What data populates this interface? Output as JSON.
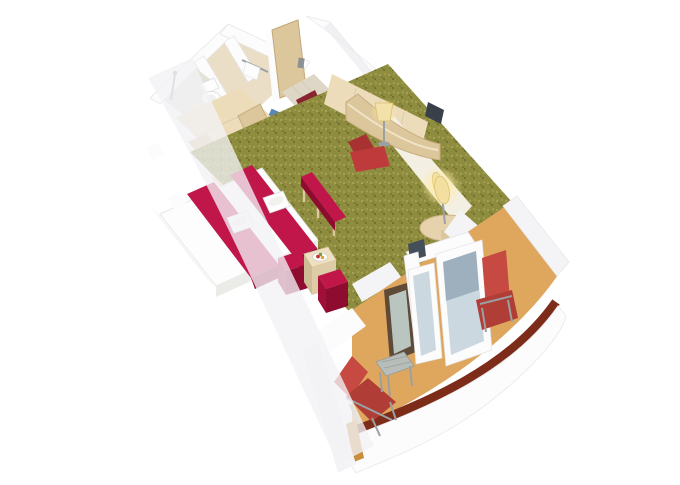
{
  "scene": {
    "title": "3D cutaway render of a cruise-ship balcony stateroom floor plan",
    "type": "isometric architectural rendering, no visible text",
    "areas": [
      {
        "name": "bathroom",
        "description": "top-left wet unit with shower stall, toilet and second shower compartment, beige walls with white wall tops"
      },
      {
        "name": "wardrobe",
        "description": "light wood closet and open shelving with stepped shelf unit next to bathroom"
      },
      {
        "name": "entry",
        "description": "wooden cabin door at top with red striped runner mat leading onto the carpet"
      },
      {
        "name": "living-area",
        "description": "olive-green speckled carpet, double bed with white duvet, two crimson bed runners with folded white towels, crimson bench at bed foot, two crimson stools and light wood coffee table with fruit tray"
      },
      {
        "name": "desk-area",
        "description": "curved light-wood desk with lit table lamp, red desk chair, wood cabinets and TV along right wall, cream wall with glowing sconce, round pedestal side table with floor lamp"
      },
      {
        "name": "balcony",
        "description": "tan-floored private balcony behind white sliding glass door unit, two red deck chairs, grey metal side table, white ship hull with dark red trim stripe curving along the edge"
      }
    ],
    "objects": [
      "shower",
      "toilet",
      "towel-rail",
      "wardrobe-shelves",
      "step-shelves",
      "cabin-door",
      "striped-entry-mat",
      "double-bed",
      "bed-runner",
      "towel-set",
      "bed-bench",
      "stool",
      "stool",
      "coffee-table",
      "fruit-tray",
      "desk",
      "desk-lamp",
      "desk-chair",
      "tv",
      "wall-sconce",
      "side-table",
      "floor-lamp",
      "sliding-door-unit",
      "open-glass-door",
      "deck-lounger",
      "deck-chair",
      "balcony-table",
      "ship-hull",
      "hull-trim-stripe",
      "ghost-hull-wall"
    ]
  },
  "colors": {
    "hull-white": "#fcfcfd",
    "wall-white": "#f4f4f6",
    "wall-cream": "#f3efe2",
    "wood-light": "#ecdcba",
    "wood-mid": "#dcc69c",
    "wood-dark": "#c6ab7e",
    "carpet": "#8e8c3e",
    "carpet-dot-light": "#aba75a",
    "carpet-dot-dark": "#6c6a28",
    "crimson": "#c0164a",
    "crimson-mid": "#a00f36",
    "crimson-dark": "#8e0c2f",
    "chair-red": "#bf3a3a",
    "deckchair-red": "#c64a42",
    "deckchair-red-dark": "#b03d36",
    "balcony-floor": "#dfa75e",
    "balcony-edge": "#c98d3e",
    "hull-trim": "#7d2c1a",
    "glass": "#ccd8e0",
    "glass-dark": "#8fa3b2",
    "door-frame-dark": "#5f4a38",
    "metal-gray": "#9aa0a4",
    "white-linen": "#fdfdfd",
    "mat-red": "#8a2430",
    "mat-stripe": "#55161d",
    "bath-beige": "#eadfc6",
    "ghost-wall": "rgba(242,242,246,0.78)",
    "background": "#ffffff"
  }
}
